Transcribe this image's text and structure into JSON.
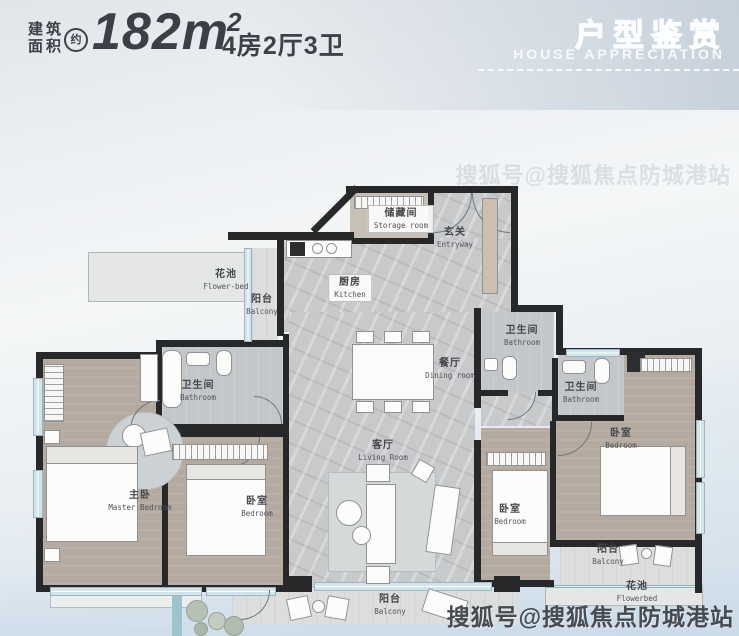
{
  "header": {
    "area_label_line1": "建筑",
    "area_label_line2": "面积",
    "approx_badge": "约",
    "area_value": "182m",
    "area_superscript": "2",
    "layout_summary": "4房2厅3卫",
    "banner_title_cn": "户型鉴赏",
    "banner_title_en": "HOUSE APPRECIATION"
  },
  "floorplan": {
    "rooms": [
      {
        "cn": "储藏间",
        "en": "Storage room"
      },
      {
        "cn": "玄关",
        "en": "Entryway"
      },
      {
        "cn": "厨房",
        "en": "Kitchen"
      },
      {
        "cn": "花池",
        "en": "Flower-bed"
      },
      {
        "cn": "阳台",
        "en": "Balcony"
      },
      {
        "cn": "卫生间",
        "en": "Bathroom"
      },
      {
        "cn": "餐厅",
        "en": "Dining room"
      },
      {
        "cn": "客厅",
        "en": "Living Room"
      },
      {
        "cn": "主卧",
        "en": "Master Bedroom"
      },
      {
        "cn": "卧室",
        "en": "Bedroom"
      },
      {
        "cn": "卫生间",
        "en": "Bathroom"
      },
      {
        "cn": "卫生间",
        "en": "Bathroom"
      },
      {
        "cn": "卧室",
        "en": "Bedroom"
      },
      {
        "cn": "卧室",
        "en": "Bedroom"
      },
      {
        "cn": "阳台",
        "en": "Balcony"
      },
      {
        "cn": "花池",
        "en": "Flowerbed"
      },
      {
        "cn": "阳台",
        "en": "Balcony"
      }
    ]
  },
  "watermark": {
    "text": "搜狐号@搜狐焦点防城港站"
  },
  "colors": {
    "wall": "#26282a",
    "floor_marble": "#c7c9cb",
    "floor_bedroom": "#b4aaa0",
    "floor_bathroom": "#c3c7c9",
    "window_glass": "#cfe4eb",
    "accent_teal": "#9fc3cd",
    "header_text": "#3d4248",
    "banner_text": "#ffffff",
    "watermark_text": "#464b52"
  }
}
